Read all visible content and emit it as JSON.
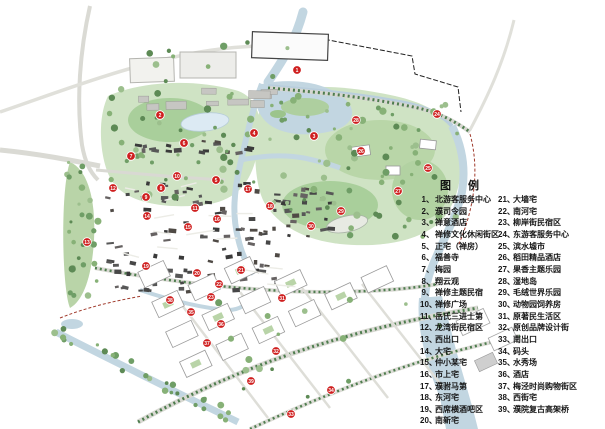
{
  "legend": {
    "title": "图 例",
    "separator": "、",
    "column1": [
      {
        "num": "1",
        "label": "北游客服务中心"
      },
      {
        "num": "2",
        "label": "濮司令园"
      },
      {
        "num": "3",
        "label": "禅意酒店"
      },
      {
        "num": "4",
        "label": "禅修文化休闲街区"
      },
      {
        "num": "5",
        "label": "正宅（禅房）"
      },
      {
        "num": "6",
        "label": "福善寺"
      },
      {
        "num": "7",
        "label": "梅园"
      },
      {
        "num": "8",
        "label": "翔云观"
      },
      {
        "num": "9",
        "label": "禅修主题民宿"
      },
      {
        "num": "10",
        "label": "禅修广场"
      },
      {
        "num": "11",
        "label": "岳氏三进士第"
      },
      {
        "num": "12",
        "label": "龙湾街民宿区"
      },
      {
        "num": "13",
        "label": "西出口"
      },
      {
        "num": "14",
        "label": "大宅"
      },
      {
        "num": "15",
        "label": "仲小某宅"
      },
      {
        "num": "16",
        "label": "市上宅"
      },
      {
        "num": "17",
        "label": "濮驸马第"
      },
      {
        "num": "18",
        "label": "东河宅"
      },
      {
        "num": "19",
        "label": "西席横酒吧区"
      },
      {
        "num": "20",
        "label": "南新宅"
      }
    ],
    "column2": [
      {
        "num": "21",
        "label": "大墙宅"
      },
      {
        "num": "22",
        "label": "南河宅"
      },
      {
        "num": "23",
        "label": "柳岸街民宿区"
      },
      {
        "num": "24",
        "label": "东游客服务中心"
      },
      {
        "num": "25",
        "label": "滨水墟市"
      },
      {
        "num": "26",
        "label": "稻田精品酒店"
      },
      {
        "num": "27",
        "label": "果香主题乐园"
      },
      {
        "num": "28",
        "label": "湿地岛"
      },
      {
        "num": "29",
        "label": "毛绒世界乐园"
      },
      {
        "num": "30",
        "label": "动物园饲养房"
      },
      {
        "num": "31",
        "label": "原著民生活区"
      },
      {
        "num": "32",
        "label": "原创品牌设计街"
      },
      {
        "num": "33",
        "label": "南出口"
      },
      {
        "num": "34",
        "label": "码头"
      },
      {
        "num": "35",
        "label": "水秀场"
      },
      {
        "num": "36",
        "label": "酒店"
      },
      {
        "num": "37",
        "label": "梅泾时尚购物街区"
      },
      {
        "num": "38",
        "label": "西街宅"
      },
      {
        "num": "39",
        "label": "濮院复古高架桥"
      }
    ]
  },
  "map": {
    "colors": {
      "marker_red": "#cf1f1f",
      "water": "#c2d6e1",
      "park_light": "#cfe3c4",
      "park_mid": "#a9cf9b",
      "tree_dark": "#5d8a55",
      "road": "#dadad4",
      "building_dark": "#4a4a4a"
    },
    "markers": [
      {
        "n": "1",
        "x": 297,
        "y": 70
      },
      {
        "n": "2",
        "x": 160,
        "y": 115
      },
      {
        "n": "3",
        "x": 314,
        "y": 136
      },
      {
        "n": "4",
        "x": 254,
        "y": 133
      },
      {
        "n": "5",
        "x": 216,
        "y": 180
      },
      {
        "n": "6",
        "x": 184,
        "y": 143
      },
      {
        "n": "7",
        "x": 131,
        "y": 156
      },
      {
        "n": "8",
        "x": 161,
        "y": 188
      },
      {
        "n": "9",
        "x": 146,
        "y": 197
      },
      {
        "n": "10",
        "x": 177,
        "y": 176
      },
      {
        "n": "11",
        "x": 195,
        "y": 208
      },
      {
        "n": "12",
        "x": 113,
        "y": 188
      },
      {
        "n": "13",
        "x": 87,
        "y": 242
      },
      {
        "n": "14",
        "x": 147,
        "y": 216
      },
      {
        "n": "15",
        "x": 188,
        "y": 227
      },
      {
        "n": "16",
        "x": 217,
        "y": 219
      },
      {
        "n": "17",
        "x": 248,
        "y": 189
      },
      {
        "n": "18",
        "x": 270,
        "y": 206
      },
      {
        "n": "19",
        "x": 146,
        "y": 266
      },
      {
        "n": "20",
        "x": 197,
        "y": 273
      },
      {
        "n": "21",
        "x": 241,
        "y": 270
      },
      {
        "n": "22",
        "x": 219,
        "y": 284
      },
      {
        "n": "23",
        "x": 211,
        "y": 297
      },
      {
        "n": "24",
        "x": 437,
        "y": 114
      },
      {
        "n": "25",
        "x": 428,
        "y": 168
      },
      {
        "n": "26",
        "x": 361,
        "y": 151
      },
      {
        "n": "27",
        "x": 398,
        "y": 191
      },
      {
        "n": "28",
        "x": 356,
        "y": 120
      },
      {
        "n": "29",
        "x": 341,
        "y": 211
      },
      {
        "n": "30",
        "x": 311,
        "y": 226
      },
      {
        "n": "31",
        "x": 282,
        "y": 298
      },
      {
        "n": "32",
        "x": 276,
        "y": 351
      },
      {
        "n": "33",
        "x": 291,
        "y": 414
      },
      {
        "n": "34",
        "x": 331,
        "y": 390
      },
      {
        "n": "35",
        "x": 191,
        "y": 312
      },
      {
        "n": "36",
        "x": 221,
        "y": 324
      },
      {
        "n": "37",
        "x": 207,
        "y": 343
      },
      {
        "n": "38",
        "x": 170,
        "y": 300
      },
      {
        "n": "39",
        "x": 251,
        "y": 381
      }
    ]
  }
}
